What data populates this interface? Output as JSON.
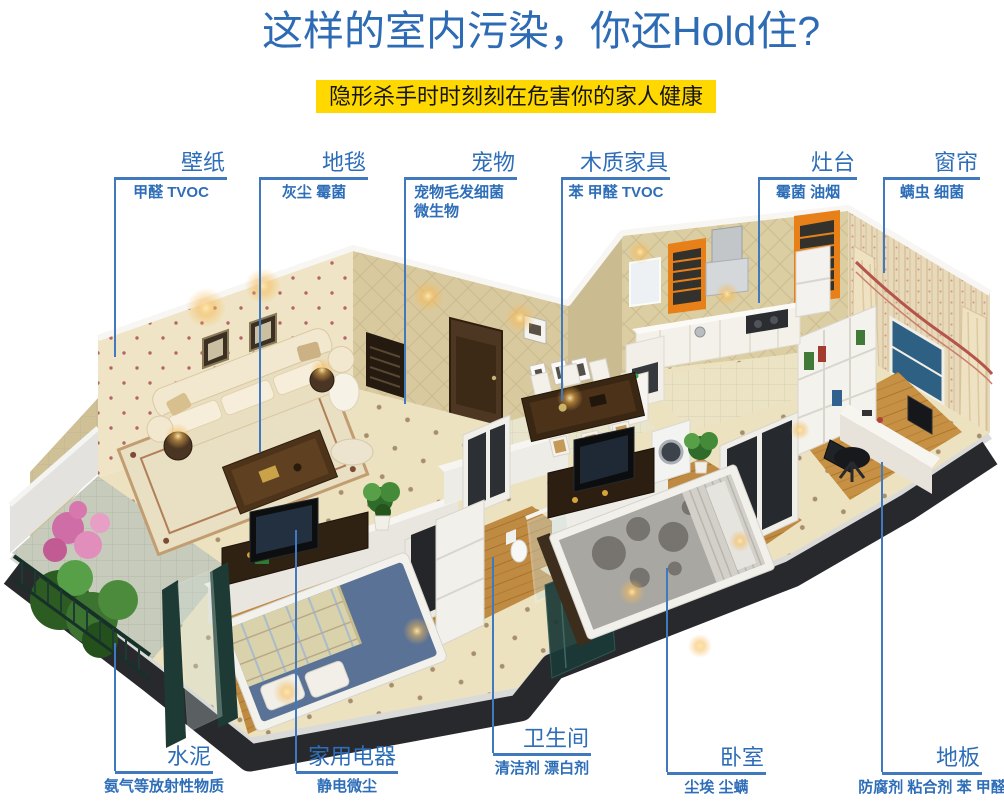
{
  "header": {
    "title": "这样的室内污染，你还Hold住?",
    "banner": "隐形杀手时时刻刻在危害你的家人健康"
  },
  "colors": {
    "title_blue": "#2d6bb4",
    "callout_blue": "#2e6eb8",
    "line_blue": "#4179be",
    "banner_yellow": "#ffd800",
    "banner_text": "#151515",
    "blind_orange": "#e8801a",
    "base_dark": "#27292d"
  },
  "callouts_top": [
    {
      "label": "壁纸",
      "pollutants": "甲醛 TVOC"
    },
    {
      "label": "地毯",
      "pollutants": "灰尘 霉菌"
    },
    {
      "label": "宠物",
      "pollutants": "宠物毛发细菌",
      "pollutants2": "微生物"
    },
    {
      "label": "木质家具",
      "pollutants": "苯 甲醛 TVOC"
    },
    {
      "label": "灶台",
      "pollutants": "霉菌 油烟"
    },
    {
      "label": "窗帘",
      "pollutants": "螨虫 细菌"
    }
  ],
  "callouts_bottom": [
    {
      "label": "水泥",
      "pollutants": "氨气等放射性物质"
    },
    {
      "label": "家用电器",
      "pollutants": "静电微尘"
    },
    {
      "label": "卫生间",
      "pollutants": "清洁剂 漂白剂"
    },
    {
      "label": "卧室",
      "pollutants": "尘埃 尘螨"
    },
    {
      "label": "地板",
      "pollutants": "防腐剂 粘合剂 苯 甲醛"
    }
  ]
}
